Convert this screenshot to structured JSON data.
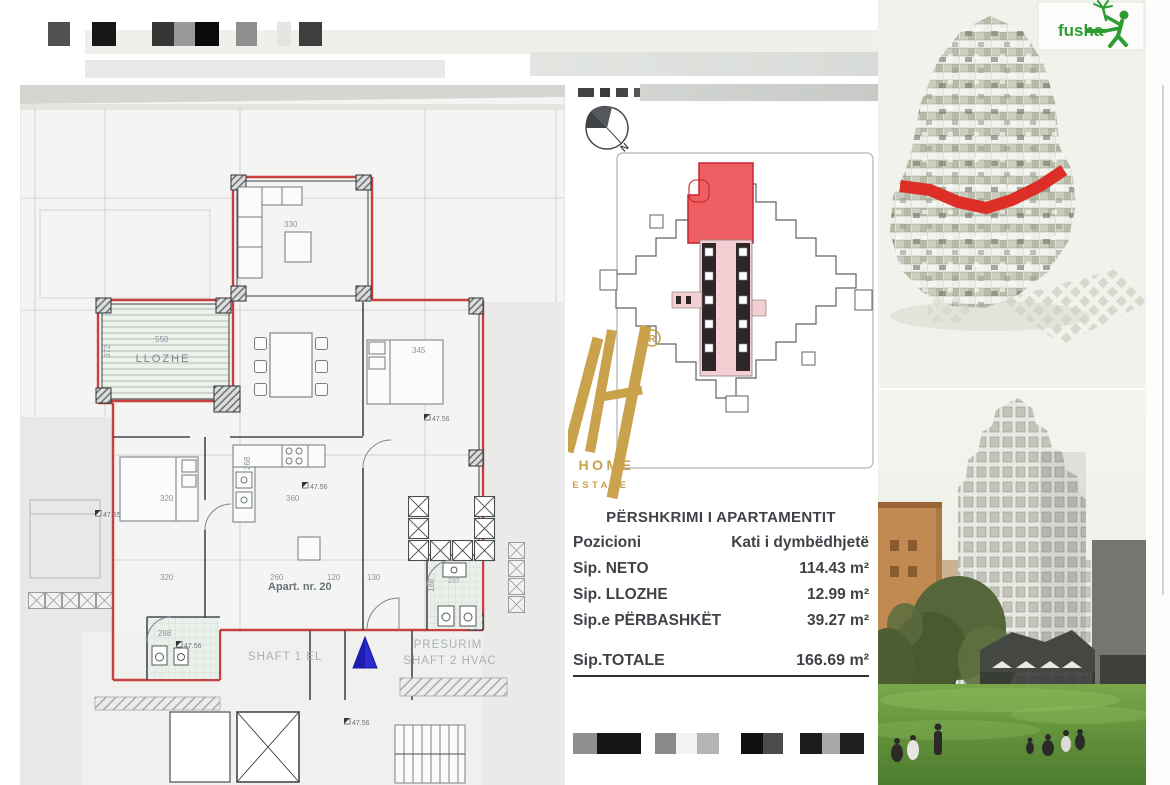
{
  "compass": {
    "n": "N"
  },
  "plan": {
    "room_llozhe": "LLOZHE",
    "apartment": "Apart. nr. 20",
    "shaft1": "SHAFT 1 EL",
    "presurim": "PRESURIM",
    "shaft2": "SHAFT 2 HVAC",
    "dims": {
      "d550": "550",
      "d372": "372",
      "d330": "330",
      "d345": "345",
      "d268": "268",
      "d320": "320",
      "d360": "360",
      "d260": "260",
      "d120": "120",
      "d130": "130",
      "d288": "288",
      "d188": "188",
      "d237": "237"
    },
    "levels": {
      "a": "47.56",
      "b": "47.55"
    }
  },
  "logo": {
    "reg": "R",
    "name": "VERO HOME",
    "tagline": "REAL ESTATE",
    "gold": "#c9a24b"
  },
  "desc": {
    "title": "PËRSHKRIMI I APARTAMENTIT",
    "rows": [
      {
        "label": "Pozicioni",
        "value": "Kati i dymbëdhjetë"
      },
      {
        "label": "Sip. NETO",
        "value": "114.43 m²"
      },
      {
        "label": "Sip. LLOZHE",
        "value": "12.99 m²"
      },
      {
        "label": "Sip.e PËRBASHKËT",
        "value": "39.27 m²"
      }
    ],
    "total": {
      "label": "Sip.TOTALE",
      "value": "166.69 m²"
    }
  },
  "fusha": {
    "label": "fusha",
    "green": "#2f9b33"
  },
  "key_plan": {
    "highlight_color": "#ee5f63"
  },
  "redactions": {
    "top": [
      {
        "x": 48,
        "w": 22,
        "c": "#4f524f"
      },
      {
        "x": 92,
        "w": 24,
        "c": "#161816"
      },
      {
        "x": 152,
        "w": 22,
        "c": "#343734"
      },
      {
        "x": 174,
        "w": 21,
        "c": "#989b98"
      },
      {
        "x": 195,
        "w": 24,
        "c": "#0a0a0a"
      },
      {
        "x": 236,
        "w": 21,
        "c": "#8d908d"
      },
      {
        "x": 277,
        "w": 14,
        "c": "#e3e6e3"
      },
      {
        "x": 299,
        "w": 23,
        "c": "#3c3f3c"
      }
    ],
    "bottom": [
      {
        "x": 573,
        "w": 24,
        "c": "#8f8f8f"
      },
      {
        "x": 597,
        "w": 44,
        "c": "#141414"
      },
      {
        "x": 655,
        "w": 21,
        "c": "#8a8a8a"
      },
      {
        "x": 676,
        "w": 21,
        "c": "#f2f2f2"
      },
      {
        "x": 697,
        "w": 22,
        "c": "#b4b4b4"
      },
      {
        "x": 741,
        "w": 22,
        "c": "#101010"
      },
      {
        "x": 763,
        "w": 20,
        "c": "#4c4c4c"
      },
      {
        "x": 800,
        "w": 22,
        "c": "#1b1b1b"
      },
      {
        "x": 822,
        "w": 18,
        "c": "#a8a8a8"
      },
      {
        "x": 840,
        "w": 24,
        "c": "#1f1f1f"
      }
    ]
  }
}
